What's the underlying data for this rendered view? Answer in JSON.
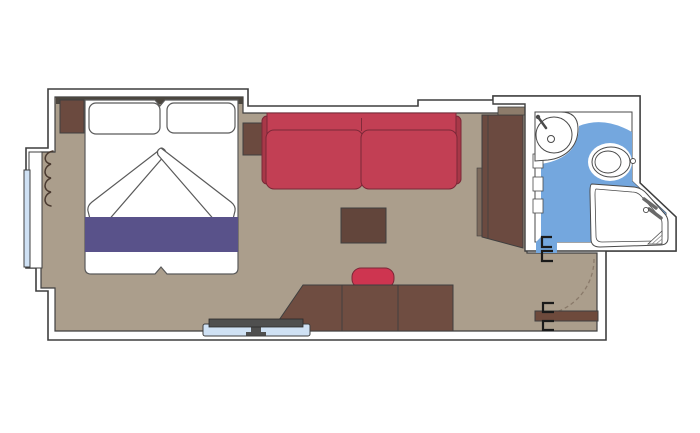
{
  "scene": {
    "type": "cruise-cabin-floor-plan",
    "rooms": [
      {
        "name": "cabin"
      },
      {
        "name": "bathroom"
      }
    ],
    "furniture": [
      "double-bed",
      "pillow-left",
      "pillow-right",
      "duvet-folds",
      "bed-runner",
      "nightstand-left",
      "nightstand-right",
      "window-with-curtain",
      "sofa",
      "coffee-table",
      "wardrobe",
      "desk",
      "stool",
      "tv-on-shelf",
      "washbasin",
      "toilet",
      "shower",
      "entry-door",
      "door-swing"
    ]
  },
  "colors": {
    "wall_fill": "#ffffff",
    "outline": "#3f3f3f",
    "fixture_outline": "#4a4a4a",
    "floor": "#ab9e8c",
    "headboard": "#4b463f",
    "bedding_white": "#ffffff",
    "bed_runner": "#59528a",
    "sofa_red": "#c23f54",
    "sofa_shadow_red": "#a83848",
    "stool_red": "#ce3550",
    "coffee_table_brown": "#62453b",
    "nightstand_brown": "#6b4a3f",
    "desk_brown": "#6f4d41",
    "wardrobe_brown": "#6b4a40",
    "wardrobe_top_brown": "#8d7c6b",
    "wardrobe_side_brown": "#7d6a5c",
    "door_brown": "#6e4a3c",
    "bathroom_floor_blue": "#74a7de",
    "glass_blue": "#cfe1f4",
    "tv_gray": "#4f4f4f",
    "door_swing_gray": "#8a7a6a",
    "handle_black": "#1a1a1a",
    "curtain_brown": "#4a3a30"
  }
}
